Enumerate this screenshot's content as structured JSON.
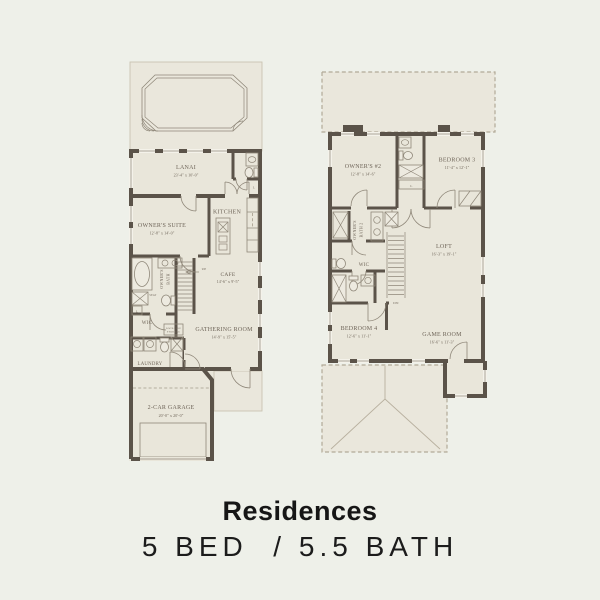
{
  "title": {
    "name": "Residences",
    "specs": "5 BED  / 5.5 BATH"
  },
  "colors": {
    "background": "#eef0e9",
    "floor_fill": "#e9e6da",
    "wall": "#5b5349",
    "line": "#8f8779",
    "text": "#6e6458",
    "dashed": "#b2aa98",
    "title_text": "#161616"
  },
  "floor1": {
    "lanai": {
      "label": "LANAI",
      "dims": "23'-4\" x 10'-0\""
    },
    "owners_suite": {
      "label": "OWNER'S SUITE",
      "dims": "12'-8\" x 14'-0\""
    },
    "kitchen": {
      "label": "KITCHEN"
    },
    "cafe": {
      "label": "CAFE",
      "dims": "14'-6\" x 9'-5\""
    },
    "gathering_room": {
      "label": "GATHERING ROOM",
      "dims": "14'-9\" x 15'-5\""
    },
    "owners_bath": {
      "line1": "OWNER'S",
      "line2": "BATH"
    },
    "seat": "SEAT",
    "wic": "WIC",
    "linen": "L",
    "lockable_storage": {
      "line1": "LOCKABLE",
      "line2": "STORAGE"
    },
    "laundry": "LAUNDRY",
    "garage": {
      "label": "2-CAR GARAGE",
      "dims": "20'-0\" x 20'-0\""
    },
    "stairs": "UP"
  },
  "floor2": {
    "owners_2": {
      "label": "OWNER'S #2",
      "dims": "12'-8\" x 14'-6\""
    },
    "bedroom_3": {
      "label": "BEDROOM 3",
      "dims": "11'-4\" x 12'-1\""
    },
    "owners_bath_2": {
      "line1": "OWNER'S",
      "line2": "BATH 2"
    },
    "wic": "WIC",
    "linen": "L",
    "loft": {
      "label": "LOFT",
      "dims": "16'-3\" x 19'-1\""
    },
    "bedroom_4": {
      "label": "BEDROOM 4",
      "dims": "12'-6\" x 11'-1\""
    },
    "game_room": {
      "label": "GAME ROOM",
      "dims": "16'-6\" x 11'-3\""
    },
    "stairs": "DN"
  }
}
